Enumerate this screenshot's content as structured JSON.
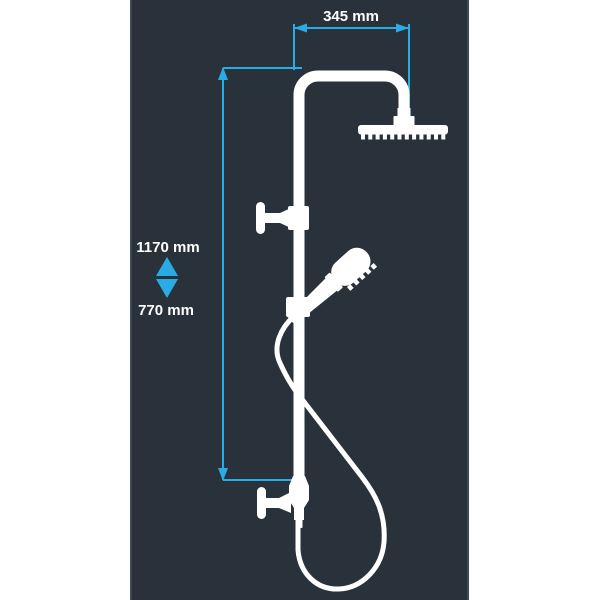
{
  "image": {
    "type": "technical-dimension-diagram",
    "subject": "shower column with overhead rain shower head, hand shower, hose and wall brackets"
  },
  "colors": {
    "canvas_background": "#ffffff",
    "panel_background": "#29323b",
    "panel_border": "#3c4a54",
    "drawing": "#ffffff",
    "dimension_accent": "#29ace3",
    "label_text": "#ffffff"
  },
  "dimensions": {
    "width_label": "345 mm",
    "height_max_label": "1170 mm",
    "height_min_label": "770 mm"
  }
}
